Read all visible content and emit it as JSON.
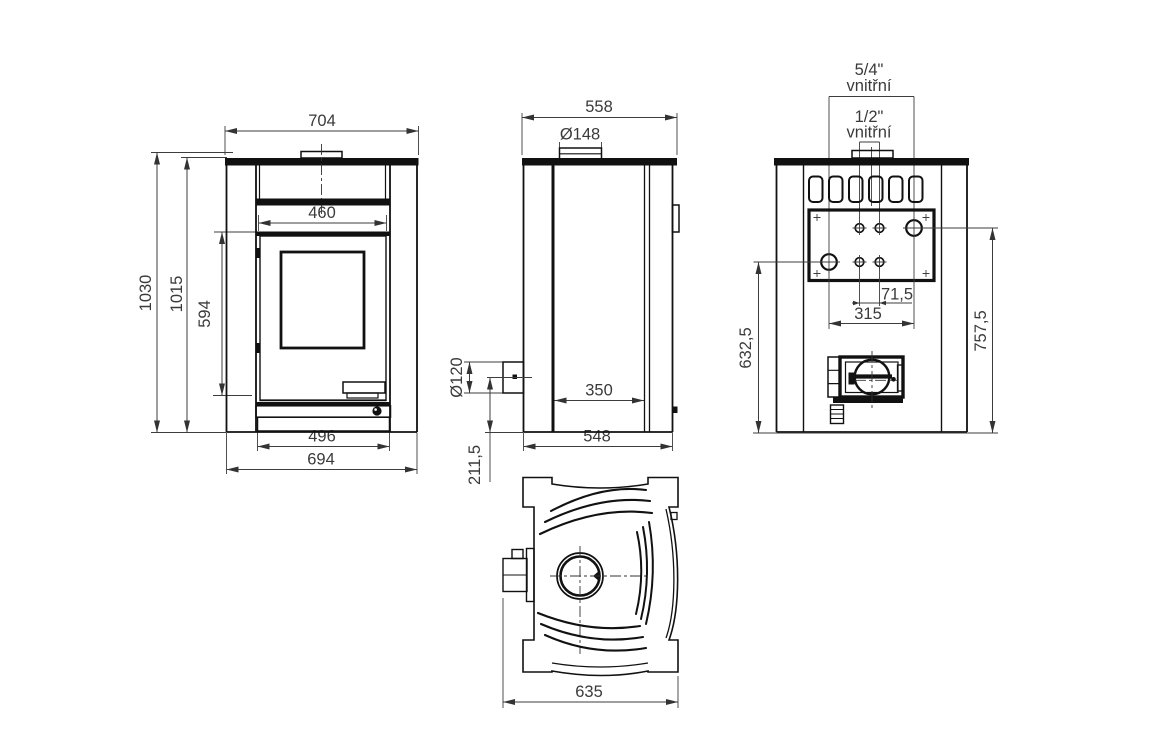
{
  "drawing": {
    "colors": {
      "background": "#ffffff",
      "line": "#111111",
      "text": "#3a3a3a"
    },
    "units": "mm",
    "views": {
      "front": {
        "dims": {
          "top_width": "704",
          "door_width": "460",
          "total_height": "1030",
          "body_height": "1015",
          "door_height": "594",
          "base_inner_width": "496",
          "base_outer_width": "694"
        }
      },
      "side": {
        "dims": {
          "top_depth": "558",
          "flue_collar_diameter": "Ø148",
          "rear_outlet_diameter": "Ø120",
          "firebox_depth": "350",
          "rear_outlet_height": "211,5",
          "base_depth": "548"
        }
      },
      "rear": {
        "dims": {
          "large_fitting_size": "5/4\"",
          "large_fitting_note": "vnitřní",
          "small_fitting_size": "1/2\"",
          "small_fitting_note": "vnitřní",
          "small_fitting_spacing": "71,5",
          "large_fitting_spacing": "315",
          "lower_fitting_height": "632,5",
          "upper_fitting_height": "757,5"
        }
      },
      "plan": {
        "dims": {
          "total_depth": "635"
        }
      }
    }
  }
}
